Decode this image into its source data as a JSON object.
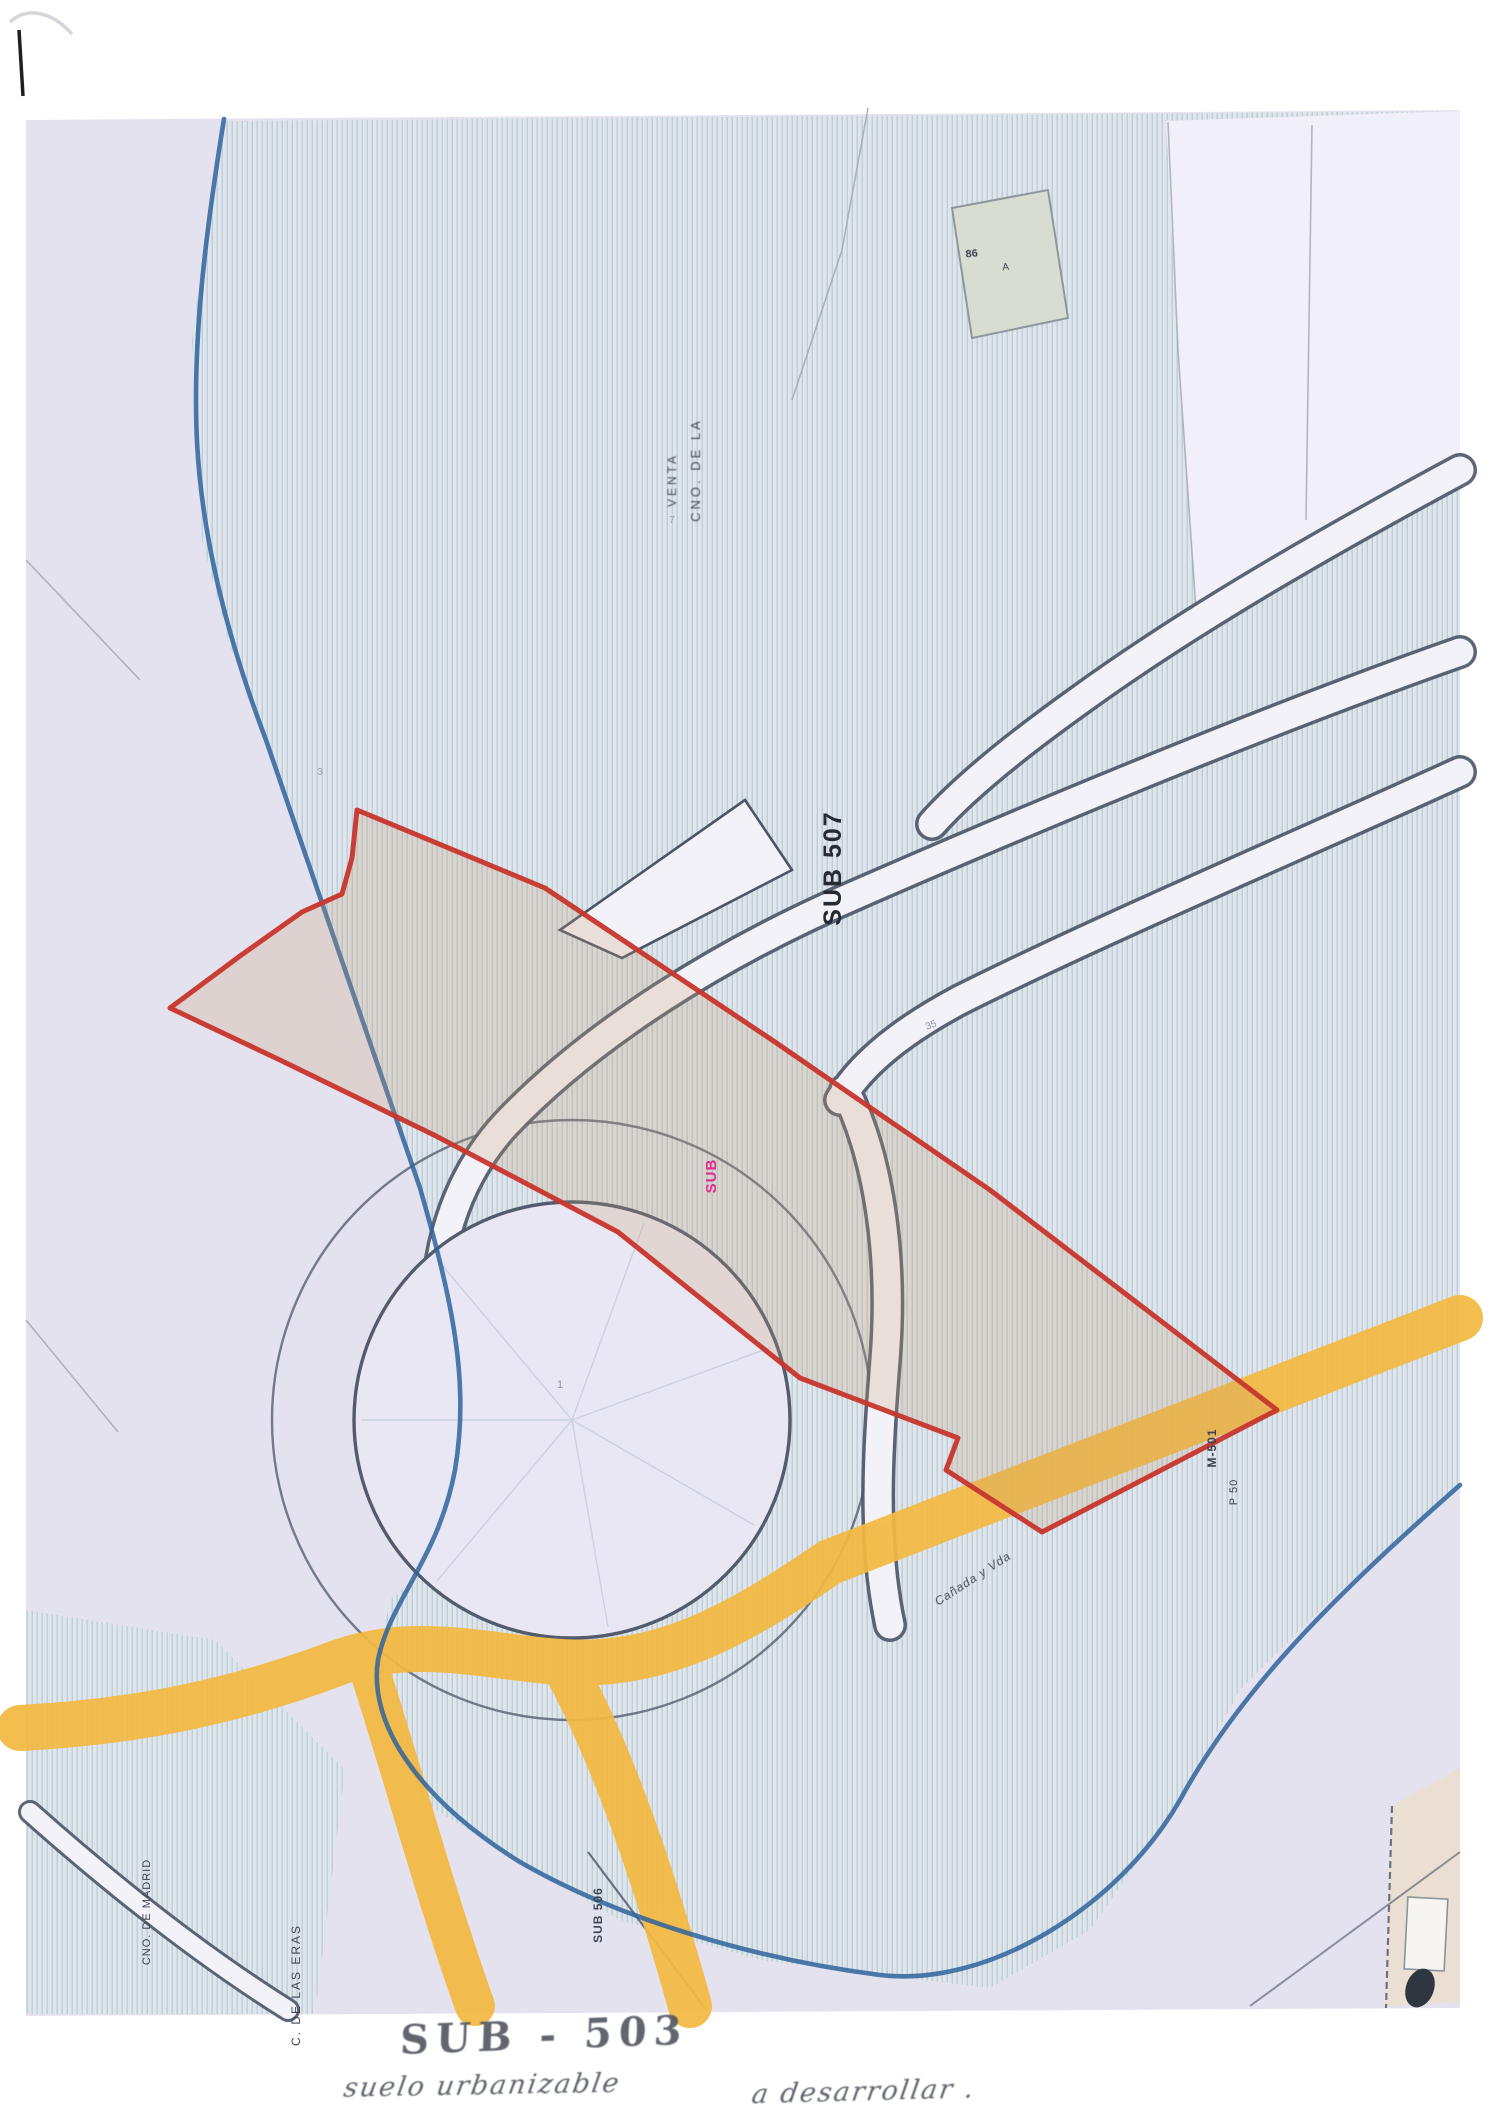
{
  "document": {
    "kind": "scanned cadastral / zoning plan",
    "handwriting": {
      "line1": "SUB - 503",
      "line2_left": "suelo urbanizable",
      "line2_right": "a desarrollar ."
    }
  },
  "colors": {
    "base_lavender": "#e5e2ef",
    "hatch_fill": "#dee6eb",
    "hatch_line": "#b6c7d2",
    "boundary_blue": "#2f639b",
    "parcel_red": "#c8372f",
    "parcel_fill": "rgba(198,156,108,0.24)",
    "road_dark": "#4b5567",
    "road_corridor": "#f3f2f8",
    "road_yellow": "#f3b942",
    "magenta": "#df2d8f"
  },
  "labels": [
    {
      "name": "road-label-top",
      "text": "CNO. DE LA",
      "x": 700,
      "y": 470,
      "rot": -90,
      "size": 13,
      "color": "#434a58",
      "weight": 400,
      "ls": 3,
      "blur": 0.45
    },
    {
      "name": "road-label-top-2",
      "text": "VENTA",
      "x": 676,
      "y": 480,
      "rot": -90,
      "size": 12,
      "color": "#434a58",
      "weight": 400,
      "ls": 3,
      "blur": 0.45
    },
    {
      "name": "sector-code-vertical",
      "text": "SUB 507",
      "x": 841,
      "y": 868,
      "rot": -90,
      "size": 25,
      "color": "#252a34",
      "weight": 700,
      "ls": 2,
      "blur": 0.2
    },
    {
      "name": "sector-code-magenta",
      "text": "SUB",
      "x": 716,
      "y": 1176,
      "rot": -90,
      "size": 15,
      "color": "#df2d8f",
      "weight": 700,
      "ls": 1,
      "blur": 0.2
    },
    {
      "name": "road-label-yellow",
      "text": "Cañada y Vda",
      "x": 975,
      "y": 1582,
      "rot": -33,
      "size": 12,
      "color": "#474e5a",
      "weight": 400,
      "ls": 1,
      "blur": 0.35,
      "style": "italic"
    },
    {
      "name": "road-label-m501",
      "text": "M-501",
      "x": 1216,
      "y": 1448,
      "rot": -90,
      "size": 12,
      "color": "#3a414d",
      "weight": 700,
      "ls": 1,
      "blur": 0.25
    },
    {
      "name": "road-label-m501-2",
      "text": "P 50",
      "x": 1237,
      "y": 1492,
      "rot": -90,
      "size": 11,
      "color": "#3a414d",
      "weight": 400,
      "ls": 1,
      "blur": 0.35
    },
    {
      "name": "road-label-bottomleft",
      "text": "CNO. DE MADRID",
      "x": 150,
      "y": 1912,
      "rot": -90,
      "size": 11,
      "color": "#3e4552",
      "weight": 400,
      "ls": 1,
      "blur": 0.35
    },
    {
      "name": "road-label-bottomleft-2",
      "text": "C. DE LAS ERAS",
      "x": 300,
      "y": 1985,
      "rot": -90,
      "size": 12,
      "color": "#3e4552",
      "weight": 400,
      "ls": 2,
      "blur": 0.35
    },
    {
      "name": "sector-label-bottom",
      "text": "SUB 506",
      "x": 602,
      "y": 1915,
      "rot": -90,
      "size": 12,
      "color": "#3e4552",
      "weight": 700,
      "ls": 1,
      "blur": 0.35
    },
    {
      "name": "building-label-1",
      "text": "86",
      "x": 972,
      "y": 257,
      "rot": -6,
      "size": 11,
      "color": "#3d4450",
      "weight": 700,
      "ls": 0,
      "blur": 0.2
    },
    {
      "name": "building-label-2",
      "text": "A",
      "x": 1006,
      "y": 270,
      "rot": -6,
      "size": 10,
      "color": "#3d4450",
      "weight": 400,
      "ls": 0,
      "blur": 0.2
    },
    {
      "name": "parcel-number-35",
      "text": "35",
      "x": 932,
      "y": 1028,
      "rot": -20,
      "size": 10,
      "color": "#8d93a5",
      "weight": 400,
      "ls": 0,
      "blur": 0.3
    },
    {
      "name": "parcel-number-7",
      "text": "7",
      "x": 672,
      "y": 523,
      "rot": 0,
      "size": 10,
      "color": "#9ba1b0",
      "weight": 400,
      "ls": 0,
      "blur": 0.3
    },
    {
      "name": "parcel-number-1",
      "text": "1",
      "x": 560,
      "y": 1388,
      "rot": 0,
      "size": 11,
      "color": "#8d93a5",
      "weight": 400,
      "ls": 0,
      "blur": 0.3
    },
    {
      "name": "parcel-number-3",
      "text": "3",
      "x": 320,
      "y": 775,
      "rot": 0,
      "size": 10,
      "color": "#9ba1b0",
      "weight": 400,
      "ls": 0,
      "blur": 0.3
    }
  ]
}
